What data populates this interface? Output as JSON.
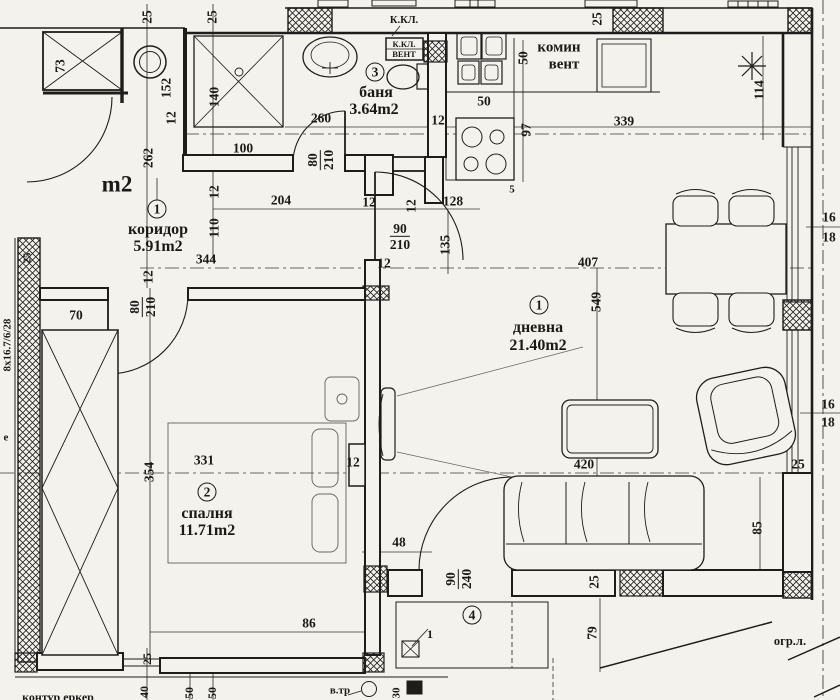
{
  "colors": {
    "ink": "#1e1d1a",
    "paper": "#f4f2ec",
    "faint": "#6b675f"
  },
  "rooms": [
    {
      "number": "1",
      "name": "коридор",
      "area": "5.91m2"
    },
    {
      "number": "1",
      "name": "дневна",
      "area": "21.40m2"
    },
    {
      "number": "2",
      "name": "спалня",
      "area": "11.71m2"
    },
    {
      "number": "3",
      "name": "баня",
      "area": "3.64m2"
    },
    {
      "number": "4"
    }
  ],
  "labels": [
    {
      "t": "25",
      "x": 147,
      "y": 17,
      "r": 1,
      "n": "dim-25"
    },
    {
      "t": "25",
      "x": 212,
      "y": 17,
      "r": 1,
      "n": "dim-25"
    },
    {
      "t": "73",
      "x": 60,
      "y": 66,
      "r": 1,
      "n": "dim-73"
    },
    {
      "t": "152",
      "x": 166,
      "y": 88,
      "r": 1,
      "n": "dim-152"
    },
    {
      "t": "140",
      "x": 214,
      "y": 97,
      "r": 1,
      "n": "dim-140"
    },
    {
      "t": "12",
      "x": 171,
      "y": 118,
      "r": 1,
      "n": "dim-12"
    },
    {
      "t": "100",
      "x": 243,
      "y": 148,
      "n": "dim-100"
    },
    {
      "t": "262",
      "x": 148,
      "y": 158,
      "r": 1,
      "n": "dim-262"
    },
    {
      "t": "m2",
      "x": 117,
      "y": 184,
      "s": 23,
      "n": "room-area-partial"
    },
    {
      "t": "260",
      "x": 321,
      "y": 118,
      "n": "dim-260"
    },
    {
      "t": "3",
      "x": 375,
      "y": 72,
      "c": 1,
      "n": "room-number-bath"
    },
    {
      "t": "баня",
      "x": 376,
      "y": 93,
      "s": 16,
      "n": "room-label-bath"
    },
    {
      "t": "3.64m2",
      "x": 374,
      "y": 110,
      "s": 16,
      "n": "room-area-bath"
    },
    {
      "t": "К.КЛ.",
      "x": 404,
      "y": 21,
      "s": 10.5,
      "n": "annotation-kkl"
    },
    {
      "t": "К.КЛ.",
      "x": 404,
      "y": 44,
      "s": 8.5,
      "n": "annotation-kkl-box"
    },
    {
      "t": "ВЕНТ",
      "x": 404,
      "y": 54,
      "s": 8.5,
      "n": "annotation-vent-box"
    },
    {
      "t": "комин",
      "x": 559,
      "y": 48,
      "s": 15,
      "n": "annotation-komin"
    },
    {
      "t": "вент",
      "x": 564,
      "y": 65,
      "s": 15,
      "n": "annotation-vent"
    },
    {
      "t": "50",
      "x": 523,
      "y": 58,
      "r": 1,
      "n": "dim-50"
    },
    {
      "t": "50",
      "x": 484,
      "y": 101,
      "n": "dim-50"
    },
    {
      "t": "12",
      "x": 438,
      "y": 120,
      "n": "dim-12"
    },
    {
      "t": "97",
      "x": 526,
      "y": 130,
      "r": 1,
      "n": "dim-97"
    },
    {
      "t": "5",
      "x": 512,
      "y": 190,
      "s": 11,
      "n": "dim-5"
    },
    {
      "t": "339",
      "x": 624,
      "y": 121,
      "n": "dim-339"
    },
    {
      "t": "25",
      "x": 597,
      "y": 19,
      "r": 1,
      "n": "dim-25"
    },
    {
      "t": "114",
      "x": 759,
      "y": 90,
      "r": 1,
      "n": "dim-114"
    },
    {
      "t": "16",
      "x": 829,
      "y": 217,
      "n": "level-16"
    },
    {
      "t": "18",
      "x": 829,
      "y": 237,
      "n": "level-18"
    },
    {
      "t": "204",
      "x": 281,
      "y": 200,
      "n": "dim-204"
    },
    {
      "t": "12",
      "x": 369,
      "y": 202,
      "n": "dim-12"
    },
    {
      "t": "12",
      "x": 411,
      "y": 206,
      "r": 1,
      "n": "dim-12"
    },
    {
      "t": "128",
      "x": 453,
      "y": 201,
      "n": "dim-128"
    },
    {
      "f": [
        "90",
        "210"
      ],
      "x": 400,
      "y": 237,
      "n": "door-dim-90-210"
    },
    {
      "t": "135",
      "x": 445,
      "y": 245,
      "r": 1,
      "n": "dim-135"
    },
    {
      "t": "12",
      "x": 384,
      "y": 263,
      "n": "dim-12"
    },
    {
      "t": "407",
      "x": 588,
      "y": 262,
      "n": "dim-407"
    },
    {
      "t": "344",
      "x": 206,
      "y": 259,
      "n": "dim-344"
    },
    {
      "t": "110",
      "x": 214,
      "y": 228,
      "r": 1,
      "n": "dim-110"
    },
    {
      "t": "12",
      "x": 214,
      "y": 192,
      "r": 1,
      "n": "dim-12"
    },
    {
      "t": "1",
      "x": 157,
      "y": 209,
      "c": 1,
      "n": "room-number-corridor"
    },
    {
      "t": "коридор",
      "x": 158,
      "y": 230,
      "s": 16,
      "n": "room-label-corridor"
    },
    {
      "t": "5.91m2",
      "x": 158,
      "y": 247,
      "s": 16,
      "n": "room-area-corridor"
    },
    {
      "t": "12",
      "x": 148,
      "y": 277,
      "r": 1,
      "n": "dim-12"
    },
    {
      "t": "25",
      "x": 28,
      "y": 258,
      "r": 1,
      "s": 11,
      "n": "dim-25"
    },
    {
      "f": [
        "80",
        "210"
      ],
      "x": 143,
      "y": 307,
      "r": 1,
      "n": "door-dim-80-210"
    },
    {
      "t": "70",
      "x": 76,
      "y": 315,
      "n": "dim-70"
    },
    {
      "f": [
        "80",
        "210"
      ],
      "x": 321,
      "y": 160,
      "r": 1,
      "n": "door-dim-80-210"
    },
    {
      "t": "8х16.7/6/28",
      "x": 8,
      "y": 345,
      "r": 1,
      "s": 11,
      "n": "stair-spec"
    },
    {
      "t": "е",
      "x": 6,
      "y": 438,
      "s": 11,
      "n": "text-partial"
    },
    {
      "t": "1",
      "x": 539,
      "y": 305,
      "c": 1,
      "n": "room-number-living"
    },
    {
      "t": "дневна",
      "x": 538,
      "y": 328,
      "s": 16,
      "n": "room-label-living"
    },
    {
      "t": "21.40m2",
      "x": 538,
      "y": 346,
      "s": 16,
      "n": "room-area-living"
    },
    {
      "t": "549",
      "x": 596,
      "y": 302,
      "r": 1,
      "n": "dim-549"
    },
    {
      "t": "331",
      "x": 204,
      "y": 460,
      "n": "dim-331"
    },
    {
      "t": "354",
      "x": 149,
      "y": 472,
      "r": 1,
      "n": "dim-354"
    },
    {
      "t": "2",
      "x": 207,
      "y": 492,
      "c": 1,
      "n": "room-number-bedroom"
    },
    {
      "t": "спалня",
      "x": 207,
      "y": 514,
      "s": 16,
      "n": "room-label-bedroom"
    },
    {
      "t": "11.71m2",
      "x": 207,
      "y": 531,
      "s": 16,
      "n": "room-area-bedroom"
    },
    {
      "t": "12",
      "x": 353,
      "y": 462,
      "n": "dim-12"
    },
    {
      "t": "48",
      "x": 399,
      "y": 542,
      "n": "dim-48"
    },
    {
      "t": "420",
      "x": 584,
      "y": 464,
      "n": "dim-420"
    },
    {
      "t": "85",
      "x": 757,
      "y": 528,
      "r": 1,
      "n": "dim-85"
    },
    {
      "t": "25",
      "x": 798,
      "y": 464,
      "n": "dim-25"
    },
    {
      "t": "16",
      "x": 828,
      "y": 404,
      "n": "level-16"
    },
    {
      "t": "18",
      "x": 828,
      "y": 422,
      "n": "level-18"
    },
    {
      "f": [
        "90",
        "240"
      ],
      "x": 459,
      "y": 579,
      "r": 1,
      "n": "door-dim-90-240"
    },
    {
      "t": "25",
      "x": 594,
      "y": 582,
      "r": 1,
      "n": "dim-25"
    },
    {
      "t": "4",
      "x": 472,
      "y": 615,
      "c": 1,
      "n": "room-number-terrace"
    },
    {
      "t": "79",
      "x": 592,
      "y": 633,
      "r": 1,
      "n": "dim-79"
    },
    {
      "t": "1",
      "x": 430,
      "y": 634,
      "s": 12,
      "n": "ref-1"
    },
    {
      "t": "огр.л.",
      "x": 790,
      "y": 641,
      "s": 12.5,
      "n": "annotation-ogr-l"
    },
    {
      "t": "86",
      "x": 309,
      "y": 623,
      "n": "dim-86"
    },
    {
      "t": "25",
      "x": 147,
      "y": 659,
      "r": 1,
      "s": 12,
      "n": "dim-25"
    },
    {
      "t": "40",
      "x": 144,
      "y": 692,
      "r": 1,
      "s": 12,
      "n": "dim-40"
    },
    {
      "t": "50",
      "x": 189,
      "y": 693,
      "r": 1,
      "s": 12,
      "n": "dim-50"
    },
    {
      "t": "50",
      "x": 212,
      "y": 693,
      "r": 1,
      "s": 12,
      "n": "dim-50"
    },
    {
      "t": "контур еркер",
      "x": 58,
      "y": 697,
      "s": 12,
      "n": "annotation-kontur"
    },
    {
      "t": "в.тр",
      "x": 340,
      "y": 691,
      "s": 11,
      "n": "annotation-vtr"
    },
    {
      "t": "30",
      "x": 397,
      "y": 693,
      "r": 1,
      "s": 11,
      "n": "dim-30"
    }
  ]
}
